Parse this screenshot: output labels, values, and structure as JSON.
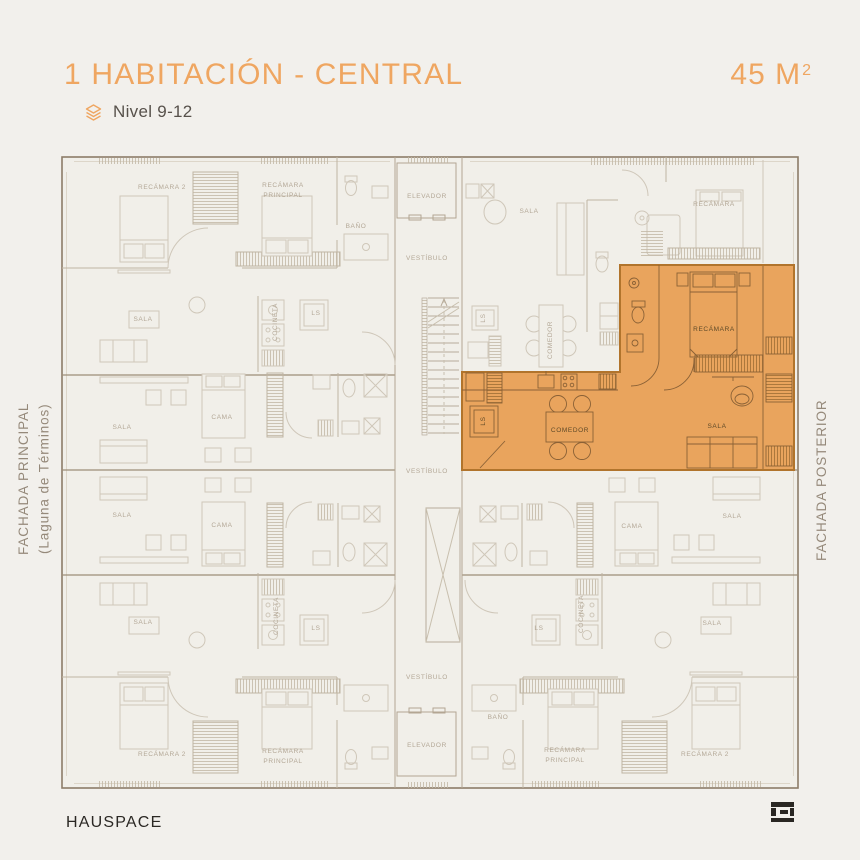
{
  "header": {
    "title": "1 HABITACIÓN - CENTRAL",
    "area_value": "45 M",
    "area_exponent": "2",
    "level_icon": "layers-icon",
    "level": "Nivel 9-12"
  },
  "facades": {
    "left_line1": "FACHADA PRINCIPAL",
    "left_line2": "(Laguna de Términos)",
    "right": "FACHADA POSTERIOR"
  },
  "footer": {
    "brand": "HAUSPACE",
    "logo": "hauspace-monogram"
  },
  "colors": {
    "background": "#f2f0ec",
    "accent_orange": "#efa661",
    "highlight_fill": "#e9a45d",
    "highlight_outline": "#b1742c",
    "faded_line": "#cfc7b9",
    "wall": "#8d7c68",
    "label_gray": "#b3a796",
    "label_dark": "#5f4a28",
    "text_dark": "#2b2824",
    "text_medium": "#57514b",
    "facade_label": "#95897a"
  },
  "plan": {
    "highlighted_unit": "1-habitacion-central",
    "labels": [
      {
        "text": "RECÁMARA  2",
        "x": 162,
        "y": 188
      },
      {
        "text": "RECÁMARA\nPRINCIPAL",
        "x": 283,
        "y": 191
      },
      {
        "text": "BAÑO",
        "x": 356,
        "y": 227
      },
      {
        "text": "SALA",
        "x": 143,
        "y": 320
      },
      {
        "text": "COCINETA",
        "x": 276,
        "y": 322,
        "rot": true
      },
      {
        "text": "LS",
        "x": 316,
        "y": 314
      },
      {
        "text": "ELEVADOR",
        "x": 427,
        "y": 197
      },
      {
        "text": "VESTÍBULO",
        "x": 427,
        "y": 259
      },
      {
        "text": "SALA",
        "x": 529,
        "y": 212
      },
      {
        "text": "RECÁMARA",
        "x": 714,
        "y": 205
      },
      {
        "text": "LS",
        "x": 484,
        "y": 318,
        "rot": true
      },
      {
        "text": "COMEDOR",
        "x": 551,
        "y": 340,
        "rot": true
      },
      {
        "text": "SALA",
        "x": 122,
        "y": 428
      },
      {
        "text": "CAMA",
        "x": 222,
        "y": 418
      },
      {
        "text": "SALA",
        "x": 122,
        "y": 516
      },
      {
        "text": "CAMA",
        "x": 222,
        "y": 526
      },
      {
        "text": "VESTÍBULO",
        "x": 427,
        "y": 472
      },
      {
        "text": "CAMA",
        "x": 632,
        "y": 527
      },
      {
        "text": "SALA",
        "x": 732,
        "y": 517
      },
      {
        "text": "SALA",
        "x": 143,
        "y": 623
      },
      {
        "text": "COCINETA",
        "x": 277,
        "y": 616,
        "rot": true
      },
      {
        "text": "LS",
        "x": 316,
        "y": 629
      },
      {
        "text": "RECÁMARA  2",
        "x": 162,
        "y": 755
      },
      {
        "text": "RECÁMARA\nPRINCIPAL",
        "x": 283,
        "y": 757
      },
      {
        "text": "VESTÍBULO",
        "x": 427,
        "y": 678
      },
      {
        "text": "ELEVADOR",
        "x": 427,
        "y": 746
      },
      {
        "text": "SALA",
        "x": 712,
        "y": 624
      },
      {
        "text": "LS",
        "x": 539,
        "y": 629
      },
      {
        "text": "COCINETA",
        "x": 582,
        "y": 614,
        "rot": true
      },
      {
        "text": "BAÑO",
        "x": 498,
        "y": 718
      },
      {
        "text": "RECÁMARA\nPRINCIPAL",
        "x": 565,
        "y": 756
      },
      {
        "text": "RECÁMARA  2",
        "x": 705,
        "y": 755
      },
      {
        "text": "RECÁMARA",
        "x": 714,
        "y": 330,
        "tone": "o"
      },
      {
        "text": "COMEDOR",
        "x": 570,
        "y": 431,
        "tone": "o"
      },
      {
        "text": "SALA",
        "x": 717,
        "y": 427,
        "tone": "o"
      },
      {
        "text": "LS",
        "x": 484,
        "y": 421,
        "rot": true,
        "tone": "o"
      }
    ]
  }
}
